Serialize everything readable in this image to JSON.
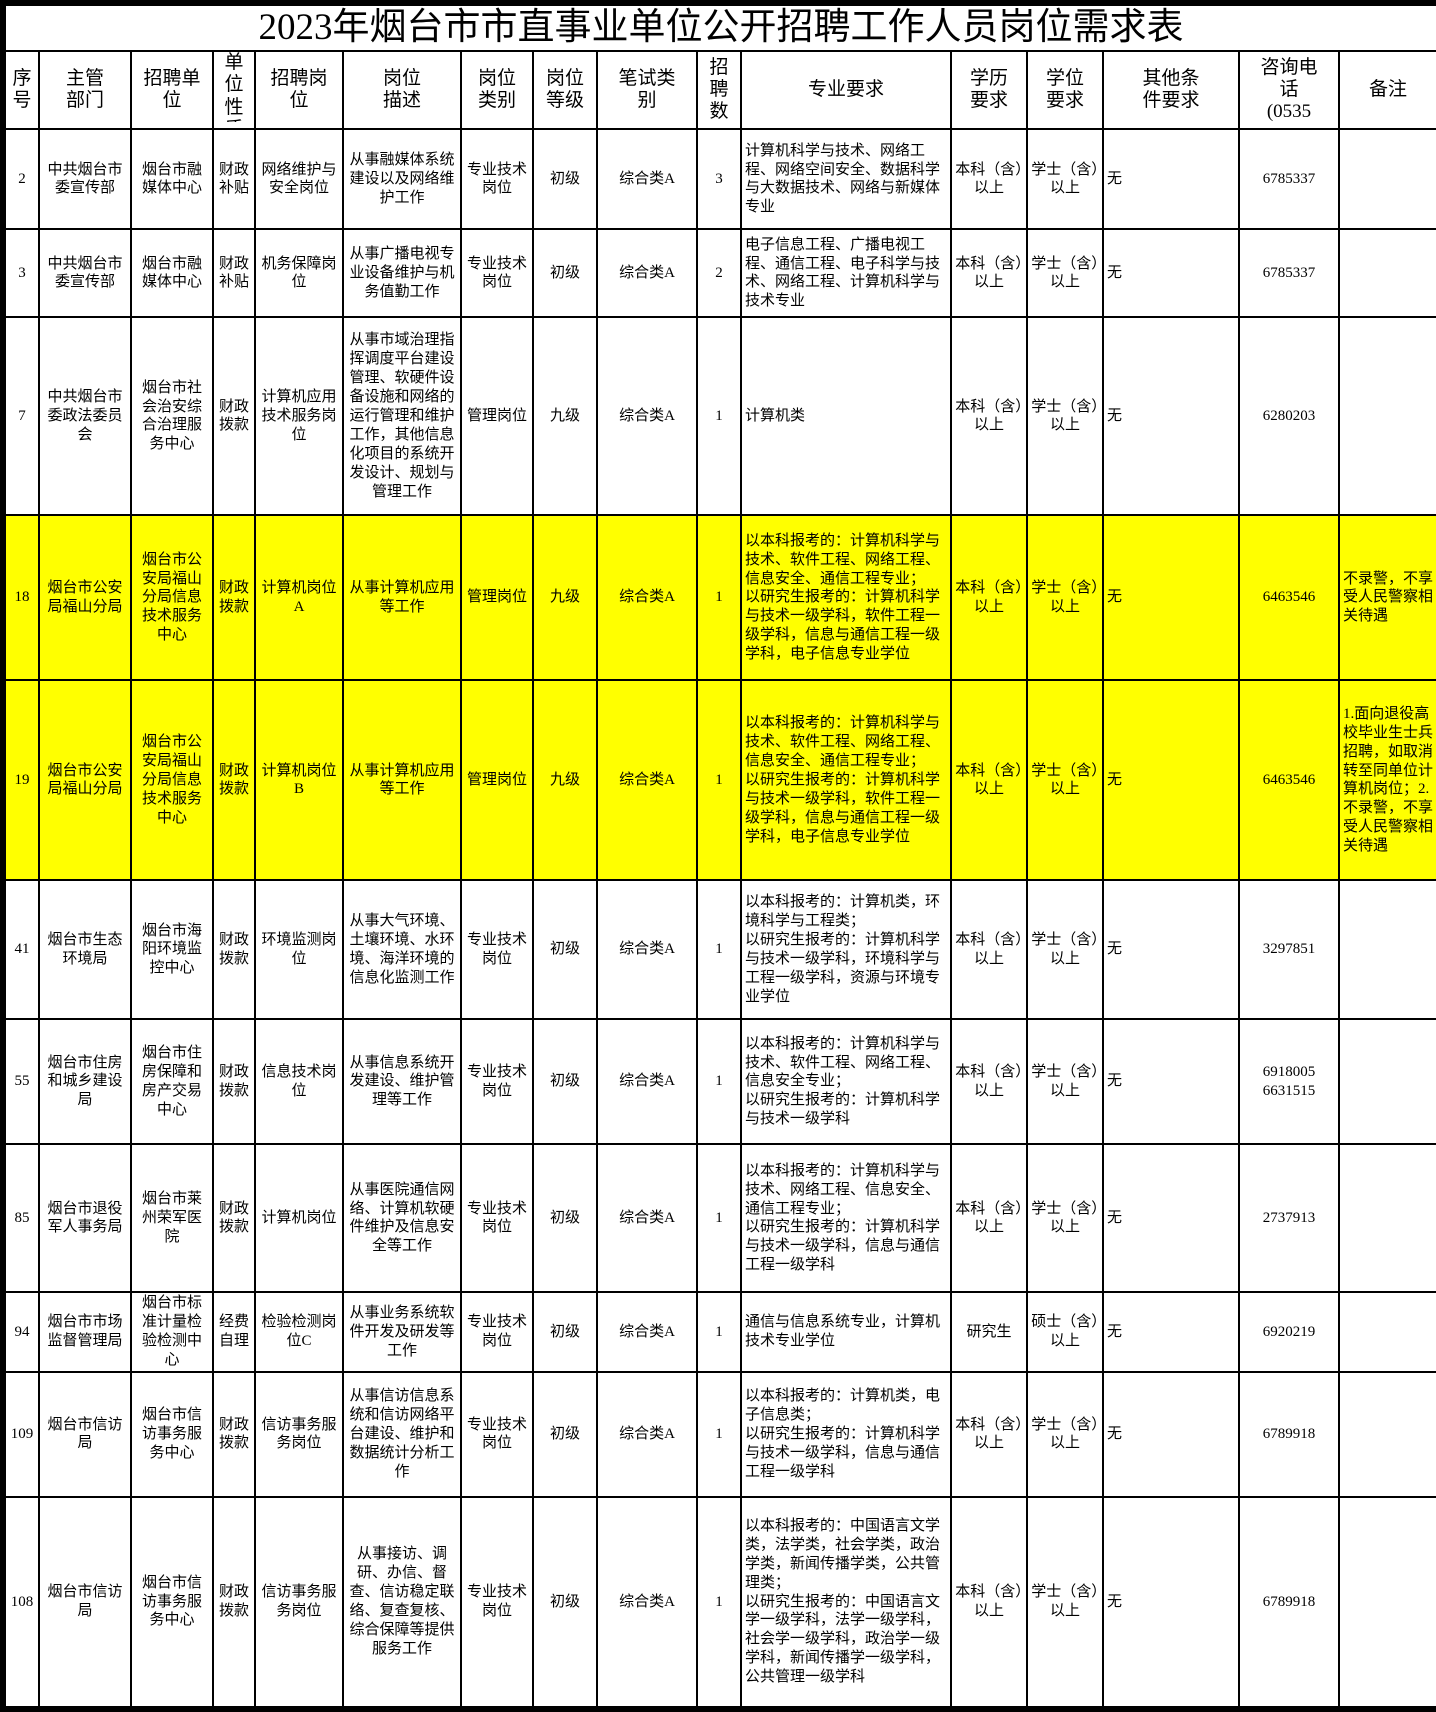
{
  "title": "2023年烟台市市直事业单位公开招聘工作人员岗位需求表",
  "colors": {
    "highlight_row": "#ffff00",
    "border": "#000000",
    "background": "#ffffff",
    "text": "#000000"
  },
  "columns": [
    {
      "key": "id",
      "label": "序\n号"
    },
    {
      "key": "dept",
      "label": "主管\n部门"
    },
    {
      "key": "unit",
      "label": "招聘单\n位"
    },
    {
      "key": "nature",
      "label": "单\n位\n性\n质"
    },
    {
      "key": "post",
      "label": "招聘岗\n位"
    },
    {
      "key": "desc",
      "label": "岗位\n描述"
    },
    {
      "key": "category",
      "label": "岗位\n类别"
    },
    {
      "key": "level",
      "label": "岗位\n等级"
    },
    {
      "key": "exam",
      "label": "笔试类\n别"
    },
    {
      "key": "count",
      "label": "招\n聘\n数"
    },
    {
      "key": "major",
      "label": "专业要求"
    },
    {
      "key": "edu",
      "label": "学历\n要求"
    },
    {
      "key": "degree",
      "label": "学位\n要求"
    },
    {
      "key": "other",
      "label": "其他条\n件要求"
    },
    {
      "key": "phone",
      "label": "咨询电\n话\n(0535"
    },
    {
      "key": "note",
      "label": "备注"
    }
  ],
  "rows": [
    {
      "id": "2",
      "dept": "中共烟台市委宣传部",
      "unit": "烟台市融媒体中心",
      "nature": "财政补贴",
      "post": "网络维护与安全岗位",
      "desc": "从事融媒体系统建设以及网络维护工作",
      "category": "专业技术岗位",
      "level": "初级",
      "exam": "综合类A",
      "count": "3",
      "major": "计算机科学与技术、网络工程、网络空间安全、数据科学与大数据技术、网络与新媒体专业",
      "edu": "本科（含）以上",
      "degree": "学士（含）以上",
      "other": "无",
      "phone": "6785337",
      "note": "",
      "highlight": false
    },
    {
      "id": "3",
      "dept": "中共烟台市委宣传部",
      "unit": "烟台市融媒体中心",
      "nature": "财政补贴",
      "post": "机务保障岗位",
      "desc": "从事广播电视专业设备维护与机务值勤工作",
      "category": "专业技术岗位",
      "level": "初级",
      "exam": "综合类A",
      "count": "2",
      "major": "电子信息工程、广播电视工程、通信工程、电子科学与技术、网络工程、计算机科学与技术专业",
      "edu": "本科（含）以上",
      "degree": "学士（含）以上",
      "other": "无",
      "phone": "6785337",
      "note": "",
      "highlight": false
    },
    {
      "id": "7",
      "dept": "中共烟台市委政法委员会",
      "unit": "烟台市社会治安综合治理服务中心",
      "nature": "财政拨款",
      "post": "计算机应用技术服务岗位",
      "desc": "从事市域治理指挥调度平台建设管理、软硬件设备设施和网络的运行管理和维护工作，其他信息化项目的系统开发设计、规划与管理工作",
      "category": "管理岗位",
      "level": "九级",
      "exam": "综合类A",
      "count": "1",
      "major": "计算机类",
      "edu": "本科（含）以上",
      "degree": "学士（含）以上",
      "other": "无",
      "phone": "6280203",
      "note": "",
      "highlight": false
    },
    {
      "id": "18",
      "dept": "烟台市公安局福山分局",
      "unit": "烟台市公安局福山分局信息技术服务中心",
      "nature": "财政拨款",
      "post": "计算机岗位A",
      "desc": "从事计算机应用等工作",
      "category": "管理岗位",
      "level": "九级",
      "exam": "综合类A",
      "count": "1",
      "major": "以本科报考的：计算机科学与技术、软件工程、网络工程、信息安全、通信工程专业；\n以研究生报考的：计算机科学与技术一级学科，软件工程一级学科，信息与通信工程一级学科，电子信息专业学位",
      "edu": "本科（含）以上",
      "degree": "学士（含）以上",
      "other": "无",
      "phone": "6463546",
      "note": "不录警，不享受人民警察相关待遇",
      "highlight": true
    },
    {
      "id": "19",
      "dept": "烟台市公安局福山分局",
      "unit": "烟台市公安局福山分局信息技术服务中心",
      "nature": "财政拨款",
      "post": "计算机岗位B",
      "desc": "从事计算机应用等工作",
      "category": "管理岗位",
      "level": "九级",
      "exam": "综合类A",
      "count": "1",
      "major": "以本科报考的：计算机科学与技术、软件工程、网络工程、信息安全、通信工程专业；\n以研究生报考的：计算机科学与技术一级学科，软件工程一级学科，信息与通信工程一级学科，电子信息专业学位",
      "edu": "本科（含）以上",
      "degree": "学士（含）以上",
      "other": "无",
      "phone": "6463546",
      "note": "1.面向退役高校毕业生士兵招聘，如取消转至同单位计算机岗位；2.不录警，不享受人民警察相关待遇",
      "highlight": true
    },
    {
      "id": "41",
      "dept": "烟台市生态环境局",
      "unit": "烟台市海阳环境监控中心",
      "nature": "财政拨款",
      "post": "环境监测岗位",
      "desc": "从事大气环境、土壤环境、水环境、海洋环境的信息化监测工作",
      "category": "专业技术岗位",
      "level": "初级",
      "exam": "综合类A",
      "count": "1",
      "major": "以本科报考的：计算机类，环境科学与工程类；\n以研究生报考的：计算机科学与技术一级学科，环境科学与工程一级学科，资源与环境专业学位",
      "edu": "本科（含）以上",
      "degree": "学士（含）以上",
      "other": "无",
      "phone": "3297851",
      "note": "",
      "highlight": false
    },
    {
      "id": "55",
      "dept": "烟台市住房和城乡建设局",
      "unit": "烟台市住房保障和房产交易中心",
      "nature": "财政拨款",
      "post": "信息技术岗位",
      "desc": "从事信息系统开发建设、维护管理等工作",
      "category": "专业技术岗位",
      "level": "初级",
      "exam": "综合类A",
      "count": "1",
      "major": "以本科报考的：计算机科学与技术、软件工程、网络工程、信息安全专业；\n以研究生报考的：计算机科学与技术一级学科",
      "edu": "本科（含）以上",
      "degree": "学士（含）以上",
      "other": "无",
      "phone": "6918005\n6631515",
      "note": "",
      "highlight": false
    },
    {
      "id": "85",
      "dept": "烟台市退役军人事务局",
      "unit": "烟台市莱州荣军医院",
      "nature": "财政拨款",
      "post": "计算机岗位",
      "desc": "从事医院通信网络、计算机软硬件维护及信息安全等工作",
      "category": "专业技术岗位",
      "level": "初级",
      "exam": "综合类A",
      "count": "1",
      "major": "以本科报考的：计算机科学与技术、网络工程、信息安全、通信工程专业；\n以研究生报考的：计算机科学与技术一级学科，信息与通信工程一级学科",
      "edu": "本科（含）以上",
      "degree": "学士（含）以上",
      "other": "无",
      "phone": "2737913",
      "note": "",
      "highlight": false
    },
    {
      "id": "94",
      "dept": "烟台市市场监督管理局",
      "unit": "烟台市标准计量检验检测中心",
      "nature": "经费自理",
      "post": "检验检测岗位C",
      "desc": "从事业务系统软件开发及研发等工作",
      "category": "专业技术岗位",
      "level": "初级",
      "exam": "综合类A",
      "count": "1",
      "major": "通信与信息系统专业，计算机技术专业学位",
      "edu": "研究生",
      "degree": "硕士（含）以上",
      "other": "无",
      "phone": "6920219",
      "note": "",
      "highlight": false
    },
    {
      "id": "109",
      "dept": "烟台市信访局",
      "unit": "烟台市信访事务服务中心",
      "nature": "财政拨款",
      "post": "信访事务服务岗位",
      "desc": "从事信访信息系统和信访网络平台建设、维护和数据统计分析工作",
      "category": "专业技术岗位",
      "level": "初级",
      "exam": "综合类A",
      "count": "1",
      "major": "以本科报考的：计算机类，电子信息类；\n以研究生报考的：计算机科学与技术一级学科，信息与通信工程一级学科",
      "edu": "本科（含）以上",
      "degree": "学士（含）以上",
      "other": "无",
      "phone": "6789918",
      "note": "",
      "highlight": false
    },
    {
      "id": "108",
      "dept": "烟台市信访局",
      "unit": "烟台市信访事务服务中心",
      "nature": "财政拨款",
      "post": "信访事务服务岗位",
      "desc": "从事接访、调研、办信、督查、信访稳定联络、复查复核、综合保障等提供服务工作",
      "category": "专业技术岗位",
      "level": "初级",
      "exam": "综合类A",
      "count": "1",
      "major": "以本科报考的：中国语言文学类，法学类，社会学类，政治学类，新闻传播学类，公共管理类；\n以研究生报考的：中国语言文学一级学科，法学一级学科，社会学一级学科，政治学一级学科，新闻传播学一级学科，公共管理一级学科",
      "edu": "本科（含）以上",
      "degree": "学士（含）以上",
      "other": "无",
      "phone": "6789918",
      "note": "",
      "highlight": false
    }
  ]
}
